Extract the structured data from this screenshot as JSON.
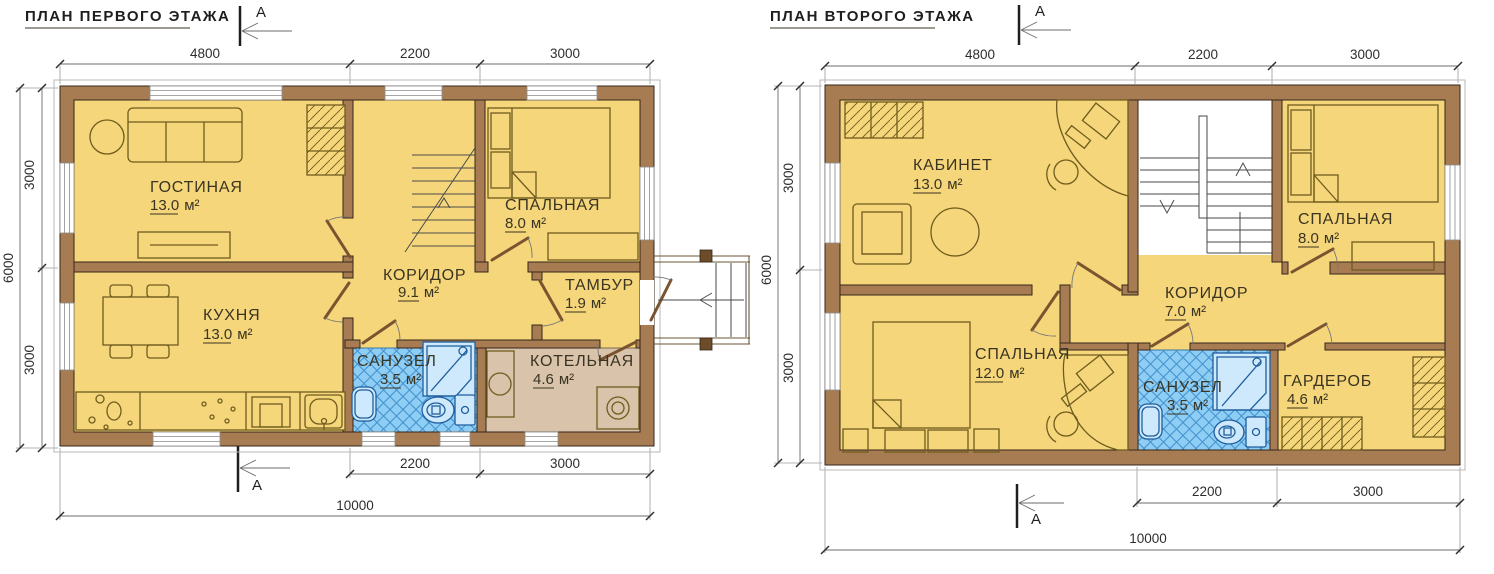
{
  "labels": {
    "unit": "м²"
  },
  "colors": {
    "wall": "#a87c52",
    "room": "#f5d67a",
    "bathroom": "#8ecdf4",
    "boiler_room": "#d9c3ab",
    "furniture_stroke": "#6f5c1e",
    "dimension_text": "#2e2e2e"
  },
  "plans": {
    "first": {
      "title": "ПЛАН ПЕРВОГО ЭТАЖА",
      "section_label": "А",
      "dims": {
        "top": [
          "4800",
          "2200",
          "3000"
        ],
        "bottom": [
          "2200",
          "3000"
        ],
        "total": "10000",
        "left": [
          "3000",
          "3000"
        ],
        "left_total": "6000"
      },
      "rooms": {
        "living": {
          "name": "ГОСТИНАЯ",
          "area": "13.0"
        },
        "bedroom": {
          "name": "СПАЛЬНАЯ",
          "area": "8.0"
        },
        "corridor": {
          "name": "КОРИДОР",
          "area": "9.1"
        },
        "tambour": {
          "name": "ТАМБУР",
          "area": "1.9"
        },
        "kitchen": {
          "name": "КУХНЯ",
          "area": "13.0"
        },
        "bathroom": {
          "name": "САНУЗЕЛ",
          "area": "3.5"
        },
        "boiler": {
          "name": "КОТЕЛЬНАЯ",
          "area": "4.6"
        }
      }
    },
    "second": {
      "title": "ПЛАН ВТОРОГО ЭТАЖА",
      "section_label": "А",
      "dims": {
        "top": [
          "4800",
          "2200",
          "3000"
        ],
        "bottom": [
          "2200",
          "3000"
        ],
        "total": "10000",
        "left": [
          "3000",
          "3000"
        ],
        "left_total": "6000"
      },
      "rooms": {
        "office": {
          "name": "КАБИНЕТ",
          "area": "13.0"
        },
        "bedroom_small": {
          "name": "СПАЛЬНАЯ",
          "area": "8.0"
        },
        "corridor": {
          "name": "КОРИДОР",
          "area": "7.0"
        },
        "bedroom_large": {
          "name": "СПАЛЬНАЯ",
          "area": "12.0"
        },
        "bathroom": {
          "name": "САНУЗЕЛ",
          "area": "3.5"
        },
        "wardrobe": {
          "name": "ГАРДЕРОБ",
          "area": "4.6"
        }
      }
    }
  }
}
